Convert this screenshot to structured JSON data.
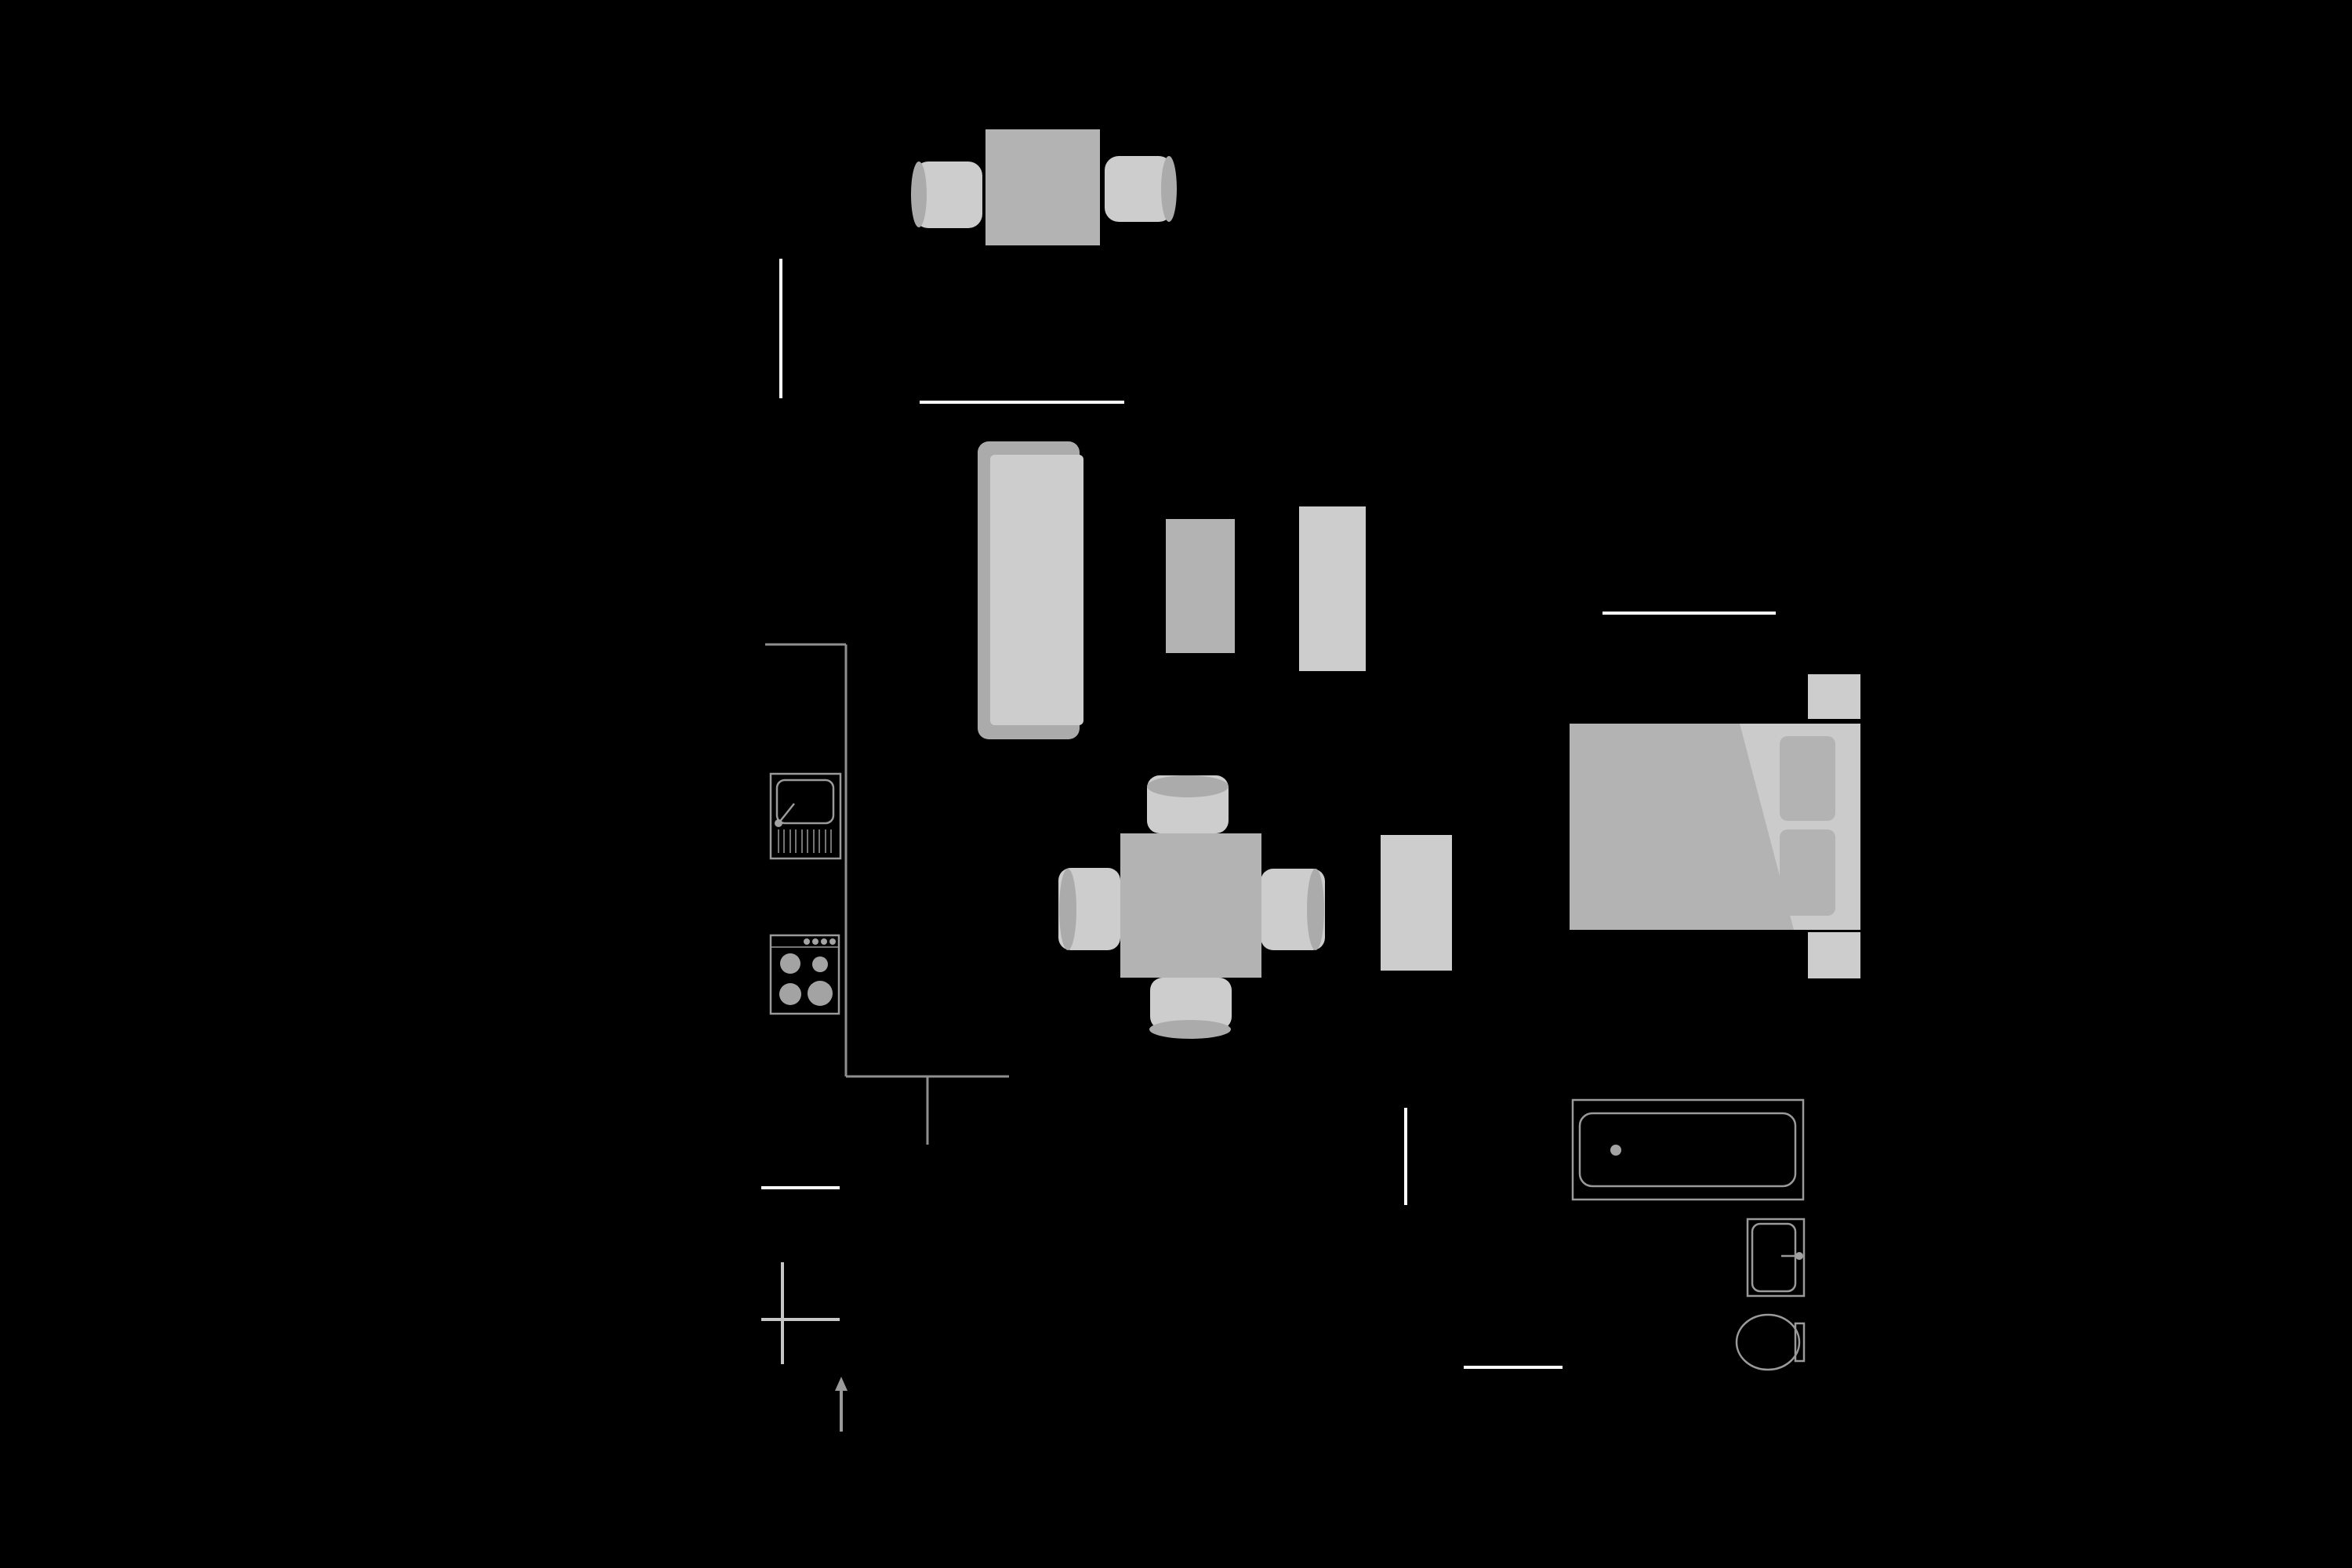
{
  "colors": {
    "background": "#000000",
    "wall": "#ffffff",
    "counter_line": "#8f8f8f",
    "fixture_outline": "#9a9a9a",
    "fixture_fill": "#a3a3a3",
    "marker": "#c6c6c6",
    "furniture_light": "#cdcdcd",
    "furniture_mid": "#b3b3b3",
    "furniture_dark": "#ababab",
    "bed_base": "#cbcbcb"
  },
  "floor_plan": {
    "balcony": {
      "items": [
        "patio-table",
        "patio-chair-left",
        "patio-chair-right"
      ]
    },
    "living_room": {
      "items": [
        "sofa",
        "coffee-table",
        "tv-bench"
      ]
    },
    "kitchen": {
      "items": [
        "kitchen-sink",
        "stove"
      ]
    },
    "dining_area": {
      "items": [
        "dining-table",
        "dining-chair-top",
        "dining-chair-bottom",
        "dining-chair-left",
        "dining-chair-right",
        "sideboard"
      ]
    },
    "bedroom": {
      "items": [
        "double-bed",
        "duvet",
        "pillow-top",
        "pillow-bottom",
        "nightstand-top",
        "nightstand-bottom"
      ]
    },
    "bathroom": {
      "items": [
        "bathtub",
        "washbasin",
        "toilet"
      ]
    },
    "annotations": {
      "items": [
        "reference-cross",
        "north-arrow"
      ]
    }
  }
}
